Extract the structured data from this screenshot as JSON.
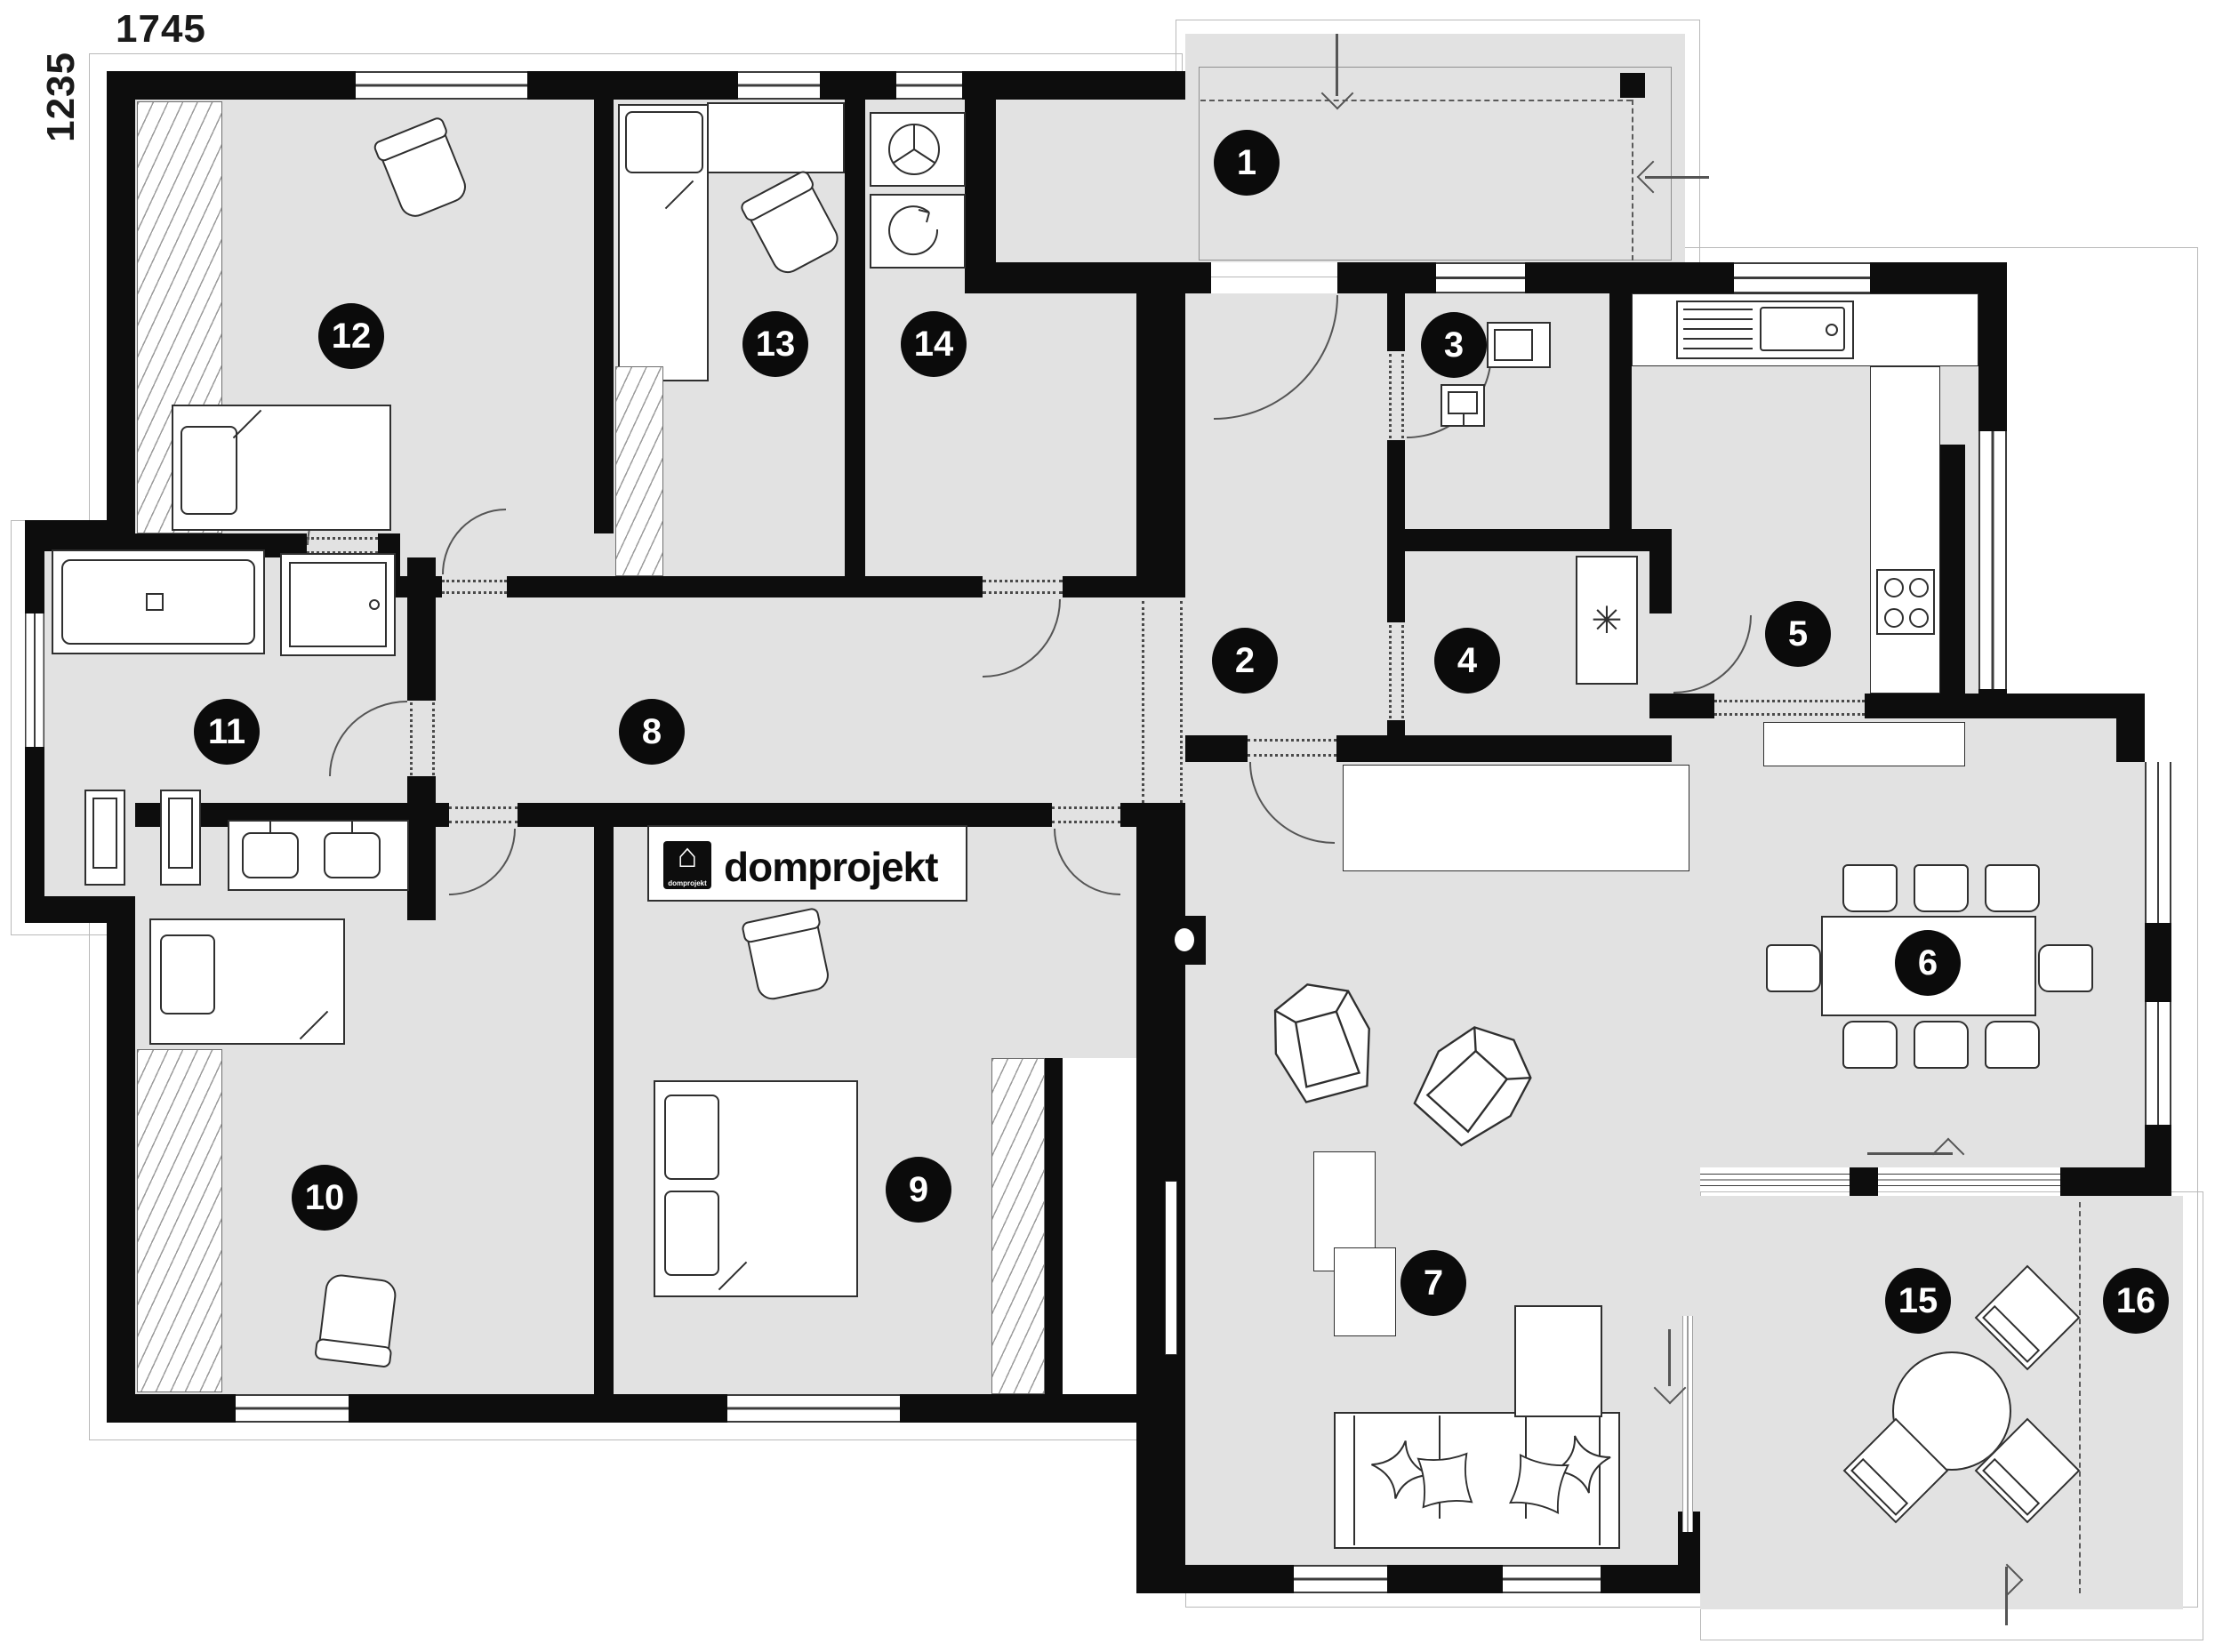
{
  "plan": {
    "dimension_width_label": "1745",
    "dimension_height_label": "1235",
    "logo_text": "domprojekt",
    "logo_caption": "domprojekt",
    "logo_house_glyph": "⌂",
    "freezer_symbol": "✳",
    "rooms": [
      {
        "number": "1"
      },
      {
        "number": "2"
      },
      {
        "number": "3"
      },
      {
        "number": "4"
      },
      {
        "number": "5"
      },
      {
        "number": "6"
      },
      {
        "number": "7"
      },
      {
        "number": "8"
      },
      {
        "number": "9"
      },
      {
        "number": "10"
      },
      {
        "number": "11"
      },
      {
        "number": "12"
      },
      {
        "number": "13"
      },
      {
        "number": "14"
      },
      {
        "number": "15"
      },
      {
        "number": "16"
      }
    ],
    "colors": {
      "wall": "#0d0d0d",
      "floor": "#e2e2e2",
      "furniture_line": "#2f2f2f",
      "badge_bg": "#0b0b0b",
      "badge_text": "#ffffff"
    },
    "icons": [
      "washing-machine-icon",
      "tumble-dryer-icon",
      "kitchen-sink-icon",
      "cooktop-icon",
      "freezer-icon",
      "bathtub-icon",
      "shower-icon",
      "toilet-icon",
      "bidet-icon",
      "double-washbasin-icon",
      "washbasin-icon",
      "fireplace-icon",
      "tv-icon",
      "entry-arrow-icon",
      "sliding-door-arrow-icon",
      "terrace-arrow-icon",
      "house-icon"
    ]
  }
}
